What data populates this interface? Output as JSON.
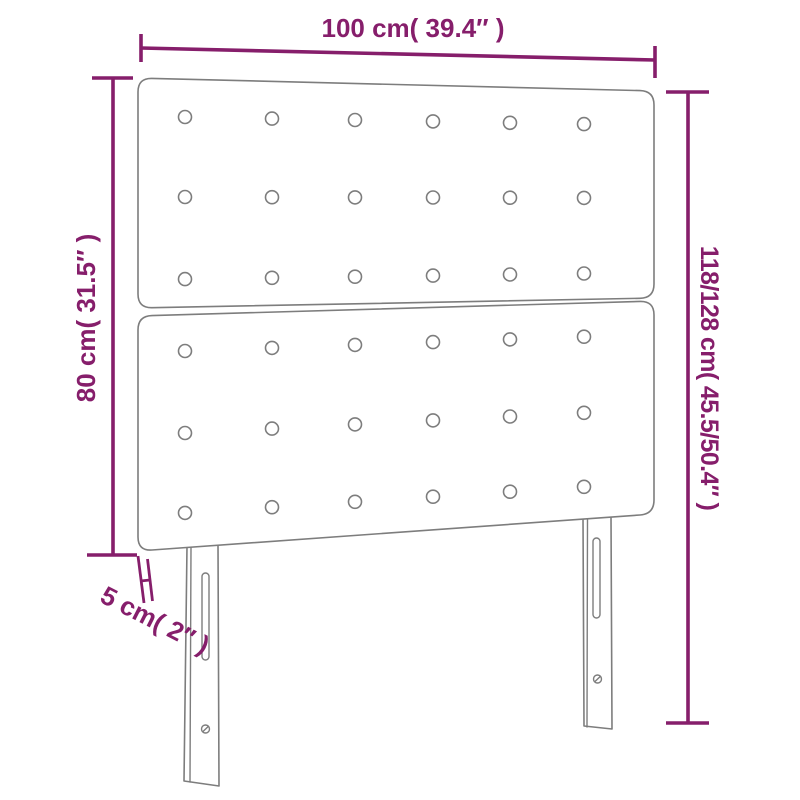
{
  "colors": {
    "accent": "#861e6b",
    "outline": "#7d7d7d",
    "background": "#ffffff"
  },
  "figure": {
    "kind": "upholstered-headboard-dimension-diagram",
    "panels": {
      "count": 2,
      "button_rows_per_panel": 3,
      "button_columns": 6
    },
    "legs": {
      "count": 2,
      "slots_per_leg": 1,
      "screw_holes_per_leg": 1
    }
  },
  "dimensions": {
    "width_label": "100 cm( 39.4″ )",
    "panel_height_label": "80 cm( 31.5″ )",
    "total_height_label": "118/128 cm( 45.5/50.4″ )",
    "thickness_label": "5 cm( 2″ )"
  }
}
